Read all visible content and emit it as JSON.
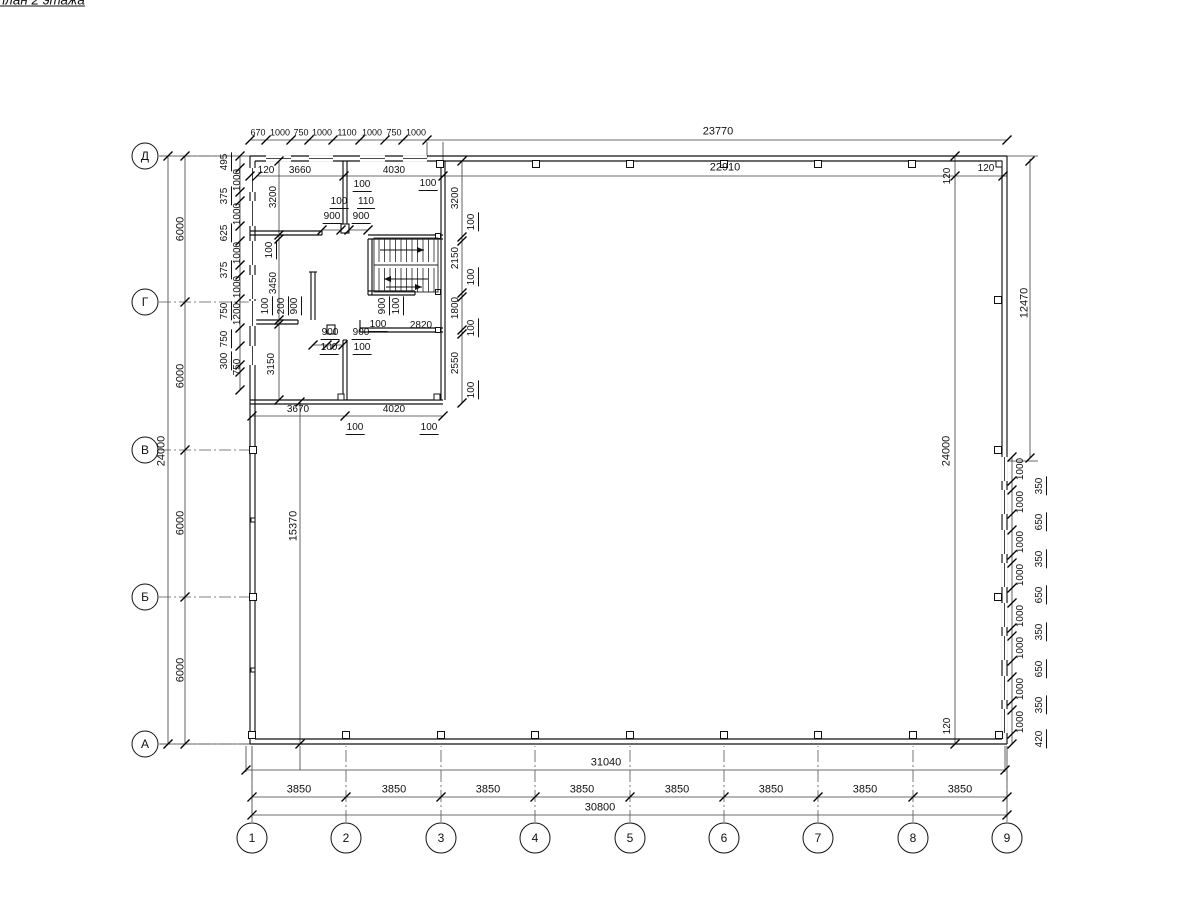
{
  "title": "Монтажный план 2 этажа",
  "row_axes": [
    {
      "label": "Д",
      "y": 156
    },
    {
      "label": "Г",
      "y": 302
    },
    {
      "label": "В",
      "y": 450
    },
    {
      "label": "Б",
      "y": 597
    },
    {
      "label": "А",
      "y": 744
    }
  ],
  "col_axes": [
    {
      "label": "1",
      "x": 252
    },
    {
      "label": "2",
      "x": 346
    },
    {
      "label": "3",
      "x": 441
    },
    {
      "label": "4",
      "x": 535
    },
    {
      "label": "5",
      "x": 630
    },
    {
      "label": "6",
      "x": 724
    },
    {
      "label": "7",
      "x": 818
    },
    {
      "label": "8",
      "x": 913
    },
    {
      "label": "9",
      "x": 1007
    }
  ],
  "labels": [
    {
      "t": "670",
      "x": 258,
      "y": 133,
      "s": "mini"
    },
    {
      "t": "1000",
      "x": 280,
      "y": 133,
      "s": "mini"
    },
    {
      "t": "750",
      "x": 301,
      "y": 133,
      "s": "mini"
    },
    {
      "t": "1000",
      "x": 322,
      "y": 133,
      "s": "mini"
    },
    {
      "t": "1100",
      "x": 347,
      "y": 133,
      "s": "mini"
    },
    {
      "t": "1000",
      "x": 372,
      "y": 133,
      "s": "mini"
    },
    {
      "t": "750",
      "x": 394,
      "y": 133,
      "s": "mini"
    },
    {
      "t": "1000",
      "x": 416,
      "y": 133,
      "s": "mini"
    },
    {
      "t": "23770",
      "x": 718,
      "y": 132,
      "s": "big"
    },
    {
      "t": "120",
      "x": 266,
      "y": 171
    },
    {
      "t": "3660",
      "x": 300,
      "y": 171
    },
    {
      "t": "4030",
      "x": 394,
      "y": 171
    },
    {
      "t": "22910",
      "x": 725,
      "y": 168,
      "s": "big"
    },
    {
      "t": "120",
      "x": 948,
      "y": 176,
      "r": 1
    },
    {
      "t": "120",
      "x": 986,
      "y": 169
    },
    {
      "t": "100",
      "x": 362,
      "y": 186,
      "u": 1
    },
    {
      "t": "100",
      "x": 428,
      "y": 185,
      "u": 1
    },
    {
      "t": "100",
      "x": 339,
      "y": 203,
      "u": 1
    },
    {
      "t": "110",
      "x": 366,
      "y": 203,
      "u": 1
    },
    {
      "t": "900",
      "x": 332,
      "y": 218,
      "u": 1
    },
    {
      "t": "900",
      "x": 361,
      "y": 218,
      "u": 1
    },
    {
      "t": "3200",
      "x": 274,
      "y": 197,
      "r": 1
    },
    {
      "t": "100",
      "x": 271,
      "y": 250,
      "r": 1,
      "u": 1
    },
    {
      "t": "3450",
      "x": 274,
      "y": 283,
      "r": 1
    },
    {
      "t": "100",
      "x": 267,
      "y": 306,
      "r": 1,
      "u": 1
    },
    {
      "t": "200",
      "x": 283,
      "y": 306,
      "r": 1,
      "u": 1
    },
    {
      "t": "900",
      "x": 296,
      "y": 306,
      "r": 1,
      "u": 1
    },
    {
      "t": "3150",
      "x": 272,
      "y": 364,
      "r": 1
    },
    {
      "t": "3200",
      "x": 456,
      "y": 198,
      "r": 1
    },
    {
      "t": "100",
      "x": 473,
      "y": 222,
      "r": 1,
      "u": 1
    },
    {
      "t": "2150",
      "x": 456,
      "y": 258,
      "r": 1
    },
    {
      "t": "100",
      "x": 473,
      "y": 277,
      "r": 1,
      "u": 1
    },
    {
      "t": "1800",
      "x": 456,
      "y": 308,
      "r": 1
    },
    {
      "t": "100",
      "x": 473,
      "y": 328,
      "r": 1,
      "u": 1
    },
    {
      "t": "2550",
      "x": 456,
      "y": 363,
      "r": 1
    },
    {
      "t": "100",
      "x": 473,
      "y": 390,
      "r": 1,
      "u": 1
    },
    {
      "t": "900",
      "x": 384,
      "y": 306,
      "r": 1,
      "u": 1
    },
    {
      "t": "100",
      "x": 398,
      "y": 306,
      "r": 1,
      "u": 1
    },
    {
      "t": "100",
      "x": 378,
      "y": 326,
      "u": 1
    },
    {
      "t": "2820",
      "x": 421,
      "y": 326
    },
    {
      "t": "900",
      "x": 330,
      "y": 334,
      "u": 1
    },
    {
      "t": "900",
      "x": 361,
      "y": 334,
      "u": 1
    },
    {
      "t": "100",
      "x": 329,
      "y": 349,
      "u": 1
    },
    {
      "t": "100",
      "x": 362,
      "y": 349,
      "u": 1
    },
    {
      "t": "3670",
      "x": 298,
      "y": 410
    },
    {
      "t": "4020",
      "x": 394,
      "y": 410
    },
    {
      "t": "100",
      "x": 355,
      "y": 429,
      "u": 1
    },
    {
      "t": "100",
      "x": 429,
      "y": 429,
      "u": 1
    },
    {
      "t": "24000",
      "x": 162,
      "y": 451,
      "r": 1,
      "s": "big"
    },
    {
      "t": "6000",
      "x": 181,
      "y": 229,
      "r": 1,
      "s": "big"
    },
    {
      "t": "6000",
      "x": 181,
      "y": 376,
      "r": 1,
      "s": "big"
    },
    {
      "t": "6000",
      "x": 181,
      "y": 523,
      "r": 1,
      "s": "big"
    },
    {
      "t": "6000",
      "x": 181,
      "y": 670,
      "r": 1,
      "s": "big"
    },
    {
      "t": "15370",
      "x": 294,
      "y": 526,
      "r": 1,
      "s": "big"
    },
    {
      "t": "495",
      "x": 226,
      "y": 162,
      "r": 1,
      "u": 1
    },
    {
      "t": "1000",
      "x": 238,
      "y": 180,
      "r": 1
    },
    {
      "t": "375",
      "x": 226,
      "y": 196,
      "r": 1,
      "u": 1
    },
    {
      "t": "1000",
      "x": 238,
      "y": 214,
      "r": 1
    },
    {
      "t": "625",
      "x": 226,
      "y": 233,
      "r": 1,
      "u": 1
    },
    {
      "t": "1000",
      "x": 238,
      "y": 253,
      "r": 1
    },
    {
      "t": "375",
      "x": 226,
      "y": 270,
      "r": 1,
      "u": 1
    },
    {
      "t": "1000",
      "x": 238,
      "y": 287,
      "r": 1
    },
    {
      "t": "750",
      "x": 226,
      "y": 311,
      "r": 1,
      "u": 1
    },
    {
      "t": "1200",
      "x": 238,
      "y": 314,
      "r": 1
    },
    {
      "t": "750",
      "x": 226,
      "y": 339,
      "r": 1,
      "u": 1
    },
    {
      "t": "300",
      "x": 226,
      "y": 361,
      "r": 1,
      "u": 1
    },
    {
      "t": "750",
      "x": 238,
      "y": 367,
      "r": 1
    },
    {
      "t": "12470",
      "x": 1025,
      "y": 303,
      "r": 1,
      "s": "big"
    },
    {
      "t": "24000",
      "x": 947,
      "y": 451,
      "r": 1,
      "s": "big"
    },
    {
      "t": "120",
      "x": 948,
      "y": 726,
      "r": 1
    },
    {
      "t": "1000",
      "x": 1021,
      "y": 469,
      "r": 1
    },
    {
      "t": "350",
      "x": 1041,
      "y": 486,
      "r": 1,
      "u": 1
    },
    {
      "t": "1000",
      "x": 1021,
      "y": 502,
      "r": 1
    },
    {
      "t": "650",
      "x": 1041,
      "y": 522,
      "r": 1,
      "u": 1
    },
    {
      "t": "1000",
      "x": 1021,
      "y": 542,
      "r": 1
    },
    {
      "t": "350",
      "x": 1041,
      "y": 559,
      "r": 1,
      "u": 1
    },
    {
      "t": "1000",
      "x": 1021,
      "y": 575,
      "r": 1
    },
    {
      "t": "650",
      "x": 1041,
      "y": 595,
      "r": 1,
      "u": 1
    },
    {
      "t": "1000",
      "x": 1021,
      "y": 616,
      "r": 1
    },
    {
      "t": "350",
      "x": 1041,
      "y": 632,
      "r": 1,
      "u": 1
    },
    {
      "t": "1000",
      "x": 1021,
      "y": 648,
      "r": 1
    },
    {
      "t": "650",
      "x": 1041,
      "y": 669,
      "r": 1,
      "u": 1
    },
    {
      "t": "1000",
      "x": 1021,
      "y": 689,
      "r": 1
    },
    {
      "t": "350",
      "x": 1041,
      "y": 705,
      "r": 1,
      "u": 1
    },
    {
      "t": "1000",
      "x": 1021,
      "y": 722,
      "r": 1
    },
    {
      "t": "420",
      "x": 1041,
      "y": 739,
      "r": 1,
      "u": 1
    },
    {
      "t": "31040",
      "x": 606,
      "y": 763,
      "s": "big"
    },
    {
      "t": "3850",
      "x": 299,
      "y": 790,
      "s": "big"
    },
    {
      "t": "3850",
      "x": 394,
      "y": 790,
      "s": "big"
    },
    {
      "t": "3850",
      "x": 488,
      "y": 790,
      "s": "big"
    },
    {
      "t": "3850",
      "x": 582,
      "y": 790,
      "s": "big"
    },
    {
      "t": "3850",
      "x": 677,
      "y": 790,
      "s": "big"
    },
    {
      "t": "3850",
      "x": 771,
      "y": 790,
      "s": "big"
    },
    {
      "t": "3850",
      "x": 865,
      "y": 790,
      "s": "big"
    },
    {
      "t": "3850",
      "x": 960,
      "y": 790,
      "s": "big"
    },
    {
      "t": "30800",
      "x": 600,
      "y": 808,
      "s": "big"
    }
  ],
  "colors": {
    "ink": "#111111",
    "dim_line": "#3c3c3c",
    "axis_line": "#555555"
  }
}
